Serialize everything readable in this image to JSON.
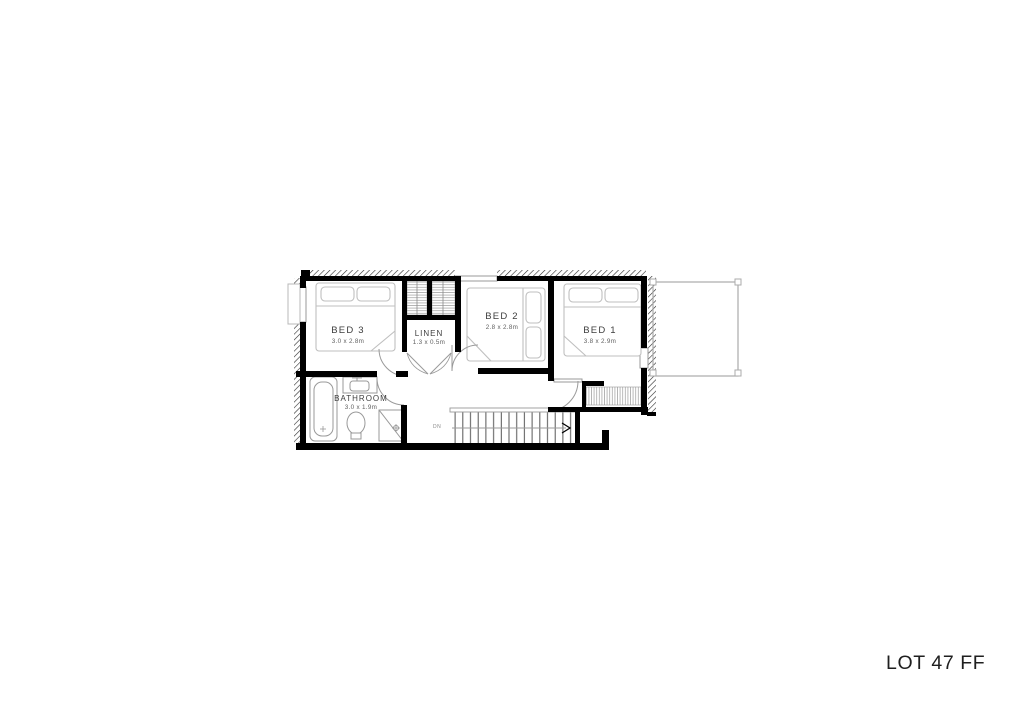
{
  "page": {
    "footer_label": "LOT 47 FF"
  },
  "plan": {
    "rooms": [
      {
        "id": "bed3",
        "label": "BED 3",
        "dims": "3.0 x 2.8m"
      },
      {
        "id": "linen",
        "label": "LINEN",
        "dims": "1.3 x 0.5m"
      },
      {
        "id": "bed2",
        "label": "BED 2",
        "dims": "2.8 x 2.8m"
      },
      {
        "id": "bed1",
        "label": "BED 1",
        "dims": "3.8 x 2.9m"
      },
      {
        "id": "bathroom",
        "label": "BATHROOM",
        "dims": "3.0 x 1.9m"
      }
    ],
    "stairs": {
      "direction_label": "DN"
    },
    "colors": {
      "wall": "#000000",
      "fixture_line": "#999999",
      "bed_line": "#bfbfbf",
      "hatch_line": "#2b2b2b",
      "text": "#3d3d3d"
    }
  }
}
